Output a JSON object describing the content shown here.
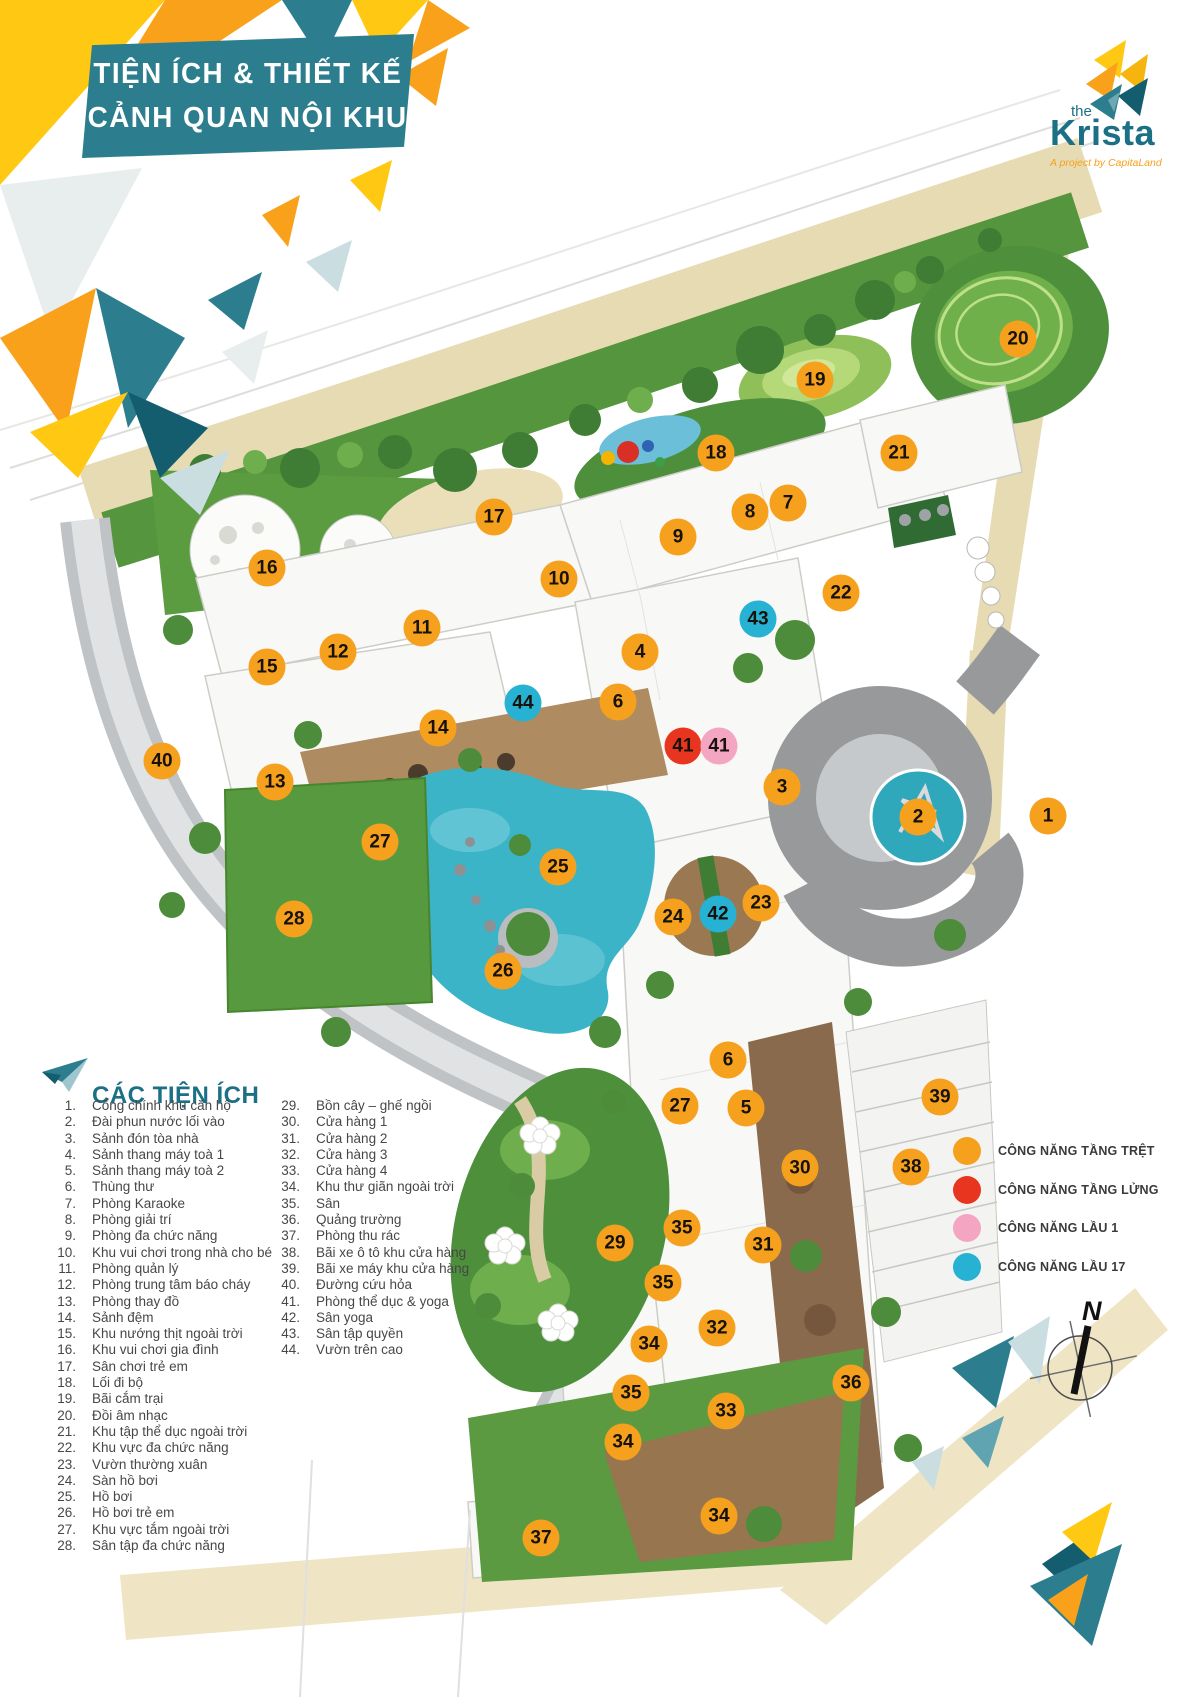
{
  "banner": {
    "line1": "TIỆN ÍCH & THIẾT KẾ",
    "line2": "CẢNH QUAN NỘI KHU"
  },
  "logo": {
    "prefix": "the",
    "name": "Krista",
    "tagline": "A project by CapitaLand"
  },
  "amenities": {
    "heading": "CÁC TIỆN ÍCH",
    "items_left": [
      {
        "num": "1.",
        "label": "Cổng chính khu căn hộ"
      },
      {
        "num": "2.",
        "label": "Đài phun nước lối vào"
      },
      {
        "num": "3.",
        "label": "Sảnh đón tòa nhà"
      },
      {
        "num": "4.",
        "label": "Sảnh thang máy toà 1"
      },
      {
        "num": "5.",
        "label": "Sảnh thang máy toà 2"
      },
      {
        "num": "6.",
        "label": "Thùng thư"
      },
      {
        "num": "7.",
        "label": "Phòng Karaoke"
      },
      {
        "num": "8.",
        "label": "Phòng giải trí"
      },
      {
        "num": "9.",
        "label": "Phòng đa chức năng"
      },
      {
        "num": "10.",
        "label": "Khu vui chơi trong nhà cho bé"
      },
      {
        "num": "11.",
        "label": "Phòng quản lý"
      },
      {
        "num": "12.",
        "label": "Phòng trung tâm báo cháy"
      },
      {
        "num": "13.",
        "label": "Phòng thay đồ"
      },
      {
        "num": "14.",
        "label": "Sảnh đệm"
      },
      {
        "num": "15.",
        "label": "Khu nướng thịt ngoài trời"
      },
      {
        "num": "16.",
        "label": "Khu vui chơi gia đình"
      },
      {
        "num": "17.",
        "label": "Sân chơi trẻ em"
      },
      {
        "num": "18.",
        "label": "Lối đi bộ"
      },
      {
        "num": "19.",
        "label": "Bãi cắm trại"
      },
      {
        "num": "20.",
        "label": "Đồi âm nhạc"
      },
      {
        "num": "21.",
        "label": "Khu tập thể dục ngoài trời"
      },
      {
        "num": "22.",
        "label": "Khu vực đa chức năng"
      },
      {
        "num": "23.",
        "label": "Vườn thường xuân"
      },
      {
        "num": "24.",
        "label": "Sàn hồ bơi"
      },
      {
        "num": "25.",
        "label": "Hồ bơi"
      },
      {
        "num": "26.",
        "label": "Hồ bơi trẻ em"
      },
      {
        "num": "27.",
        "label": "Khu vực tắm ngoài trời"
      },
      {
        "num": "28.",
        "label": "Sân tập đa chức năng"
      }
    ],
    "items_right": [
      {
        "num": "29.",
        "label": "Bồn cây – ghế ngồi"
      },
      {
        "num": "30.",
        "label": "Cửa hàng 1"
      },
      {
        "num": "31.",
        "label": "Cửa hàng 2"
      },
      {
        "num": "32.",
        "label": "Cửa hàng 3"
      },
      {
        "num": "33.",
        "label": "Cửa hàng 4"
      },
      {
        "num": "34.",
        "label": "Khu thư giãn ngoài trời"
      },
      {
        "num": "35.",
        "label": "Sân"
      },
      {
        "num": "36.",
        "label": "Quảng trường"
      },
      {
        "num": "37.",
        "label": "Phòng thu rác"
      },
      {
        "num": "38.",
        "label": "Bãi xe ô tô khu cửa hàng"
      },
      {
        "num": "39.",
        "label": "Bãi xe máy khu cửa hàng"
      },
      {
        "num": "40.",
        "label": "Đường cứu hỏa"
      },
      {
        "num": "41.",
        "label": "Phòng thể dục & yoga"
      },
      {
        "num": "42.",
        "label": "Sân yoga"
      },
      {
        "num": "43.",
        "label": "Sân tập quyền"
      },
      {
        "num": "44.",
        "label": "Vườn trên cao"
      }
    ]
  },
  "floor_legend": {
    "items": [
      {
        "label": "CÔNG NĂNG TẦNG TRỆT",
        "color": "#F6A11E"
      },
      {
        "label": "CÔNG NĂNG TẦNG LỬNG",
        "color": "#E8351F"
      },
      {
        "label": "CÔNG NĂNG LẦU 1",
        "color": "#F3A5C2"
      },
      {
        "label": "CÔNG NĂNG LẦU 17",
        "color": "#27B1D2"
      }
    ]
  },
  "compass": {
    "label": "N"
  },
  "map": {
    "marker_colors": {
      "ground": "#F6A11E",
      "mezzanine": "#E8351F",
      "floor1": "#F3A5C2",
      "floor17": "#27B1D2"
    },
    "markers": [
      {
        "n": "20",
        "x": 1018,
        "y": 339,
        "floor": "ground"
      },
      {
        "n": "19",
        "x": 815,
        "y": 380,
        "floor": "ground"
      },
      {
        "n": "18",
        "x": 716,
        "y": 453,
        "floor": "ground"
      },
      {
        "n": "21",
        "x": 899,
        "y": 453,
        "floor": "ground"
      },
      {
        "n": "7",
        "x": 788,
        "y": 503,
        "floor": "ground"
      },
      {
        "n": "8",
        "x": 750,
        "y": 512,
        "floor": "ground"
      },
      {
        "n": "17",
        "x": 494,
        "y": 517,
        "floor": "ground"
      },
      {
        "n": "9",
        "x": 678,
        "y": 537,
        "floor": "ground"
      },
      {
        "n": "16",
        "x": 267,
        "y": 568,
        "floor": "ground"
      },
      {
        "n": "10",
        "x": 559,
        "y": 579,
        "floor": "ground"
      },
      {
        "n": "22",
        "x": 841,
        "y": 593,
        "floor": "ground"
      },
      {
        "n": "43",
        "x": 758,
        "y": 619,
        "floor": "floor17"
      },
      {
        "n": "11",
        "x": 422,
        "y": 628,
        "floor": "ground"
      },
      {
        "n": "4",
        "x": 640,
        "y": 652,
        "floor": "ground"
      },
      {
        "n": "12",
        "x": 338,
        "y": 652,
        "floor": "ground"
      },
      {
        "n": "15",
        "x": 267,
        "y": 667,
        "floor": "ground"
      },
      {
        "n": "6",
        "x": 618,
        "y": 702,
        "floor": "ground"
      },
      {
        "n": "44",
        "x": 523,
        "y": 703,
        "floor": "floor17"
      },
      {
        "n": "14",
        "x": 438,
        "y": 728,
        "floor": "ground"
      },
      {
        "n": "41",
        "x": 683,
        "y": 746,
        "floor": "mezzanine"
      },
      {
        "n": "41",
        "x": 719,
        "y": 746,
        "floor": "floor1"
      },
      {
        "n": "40",
        "x": 162,
        "y": 761,
        "floor": "ground"
      },
      {
        "n": "13",
        "x": 275,
        "y": 782,
        "floor": "ground"
      },
      {
        "n": "3",
        "x": 782,
        "y": 787,
        "floor": "ground"
      },
      {
        "n": "1",
        "x": 1048,
        "y": 816,
        "floor": "ground"
      },
      {
        "n": "2",
        "x": 918,
        "y": 817,
        "floor": "ground"
      },
      {
        "n": "27",
        "x": 380,
        "y": 842,
        "floor": "ground"
      },
      {
        "n": "25",
        "x": 558,
        "y": 867,
        "floor": "ground"
      },
      {
        "n": "23",
        "x": 761,
        "y": 903,
        "floor": "ground"
      },
      {
        "n": "42",
        "x": 718,
        "y": 914,
        "floor": "floor17"
      },
      {
        "n": "24",
        "x": 673,
        "y": 917,
        "floor": "ground"
      },
      {
        "n": "28",
        "x": 294,
        "y": 919,
        "floor": "ground"
      },
      {
        "n": "26",
        "x": 503,
        "y": 971,
        "floor": "ground"
      },
      {
        "n": "6",
        "x": 728,
        "y": 1060,
        "floor": "ground"
      },
      {
        "n": "39",
        "x": 940,
        "y": 1097,
        "floor": "ground"
      },
      {
        "n": "27",
        "x": 680,
        "y": 1106,
        "floor": "ground"
      },
      {
        "n": "5",
        "x": 746,
        "y": 1108,
        "floor": "ground"
      },
      {
        "n": "38",
        "x": 911,
        "y": 1167,
        "floor": "ground"
      },
      {
        "n": "30",
        "x": 800,
        "y": 1168,
        "floor": "ground"
      },
      {
        "n": "35",
        "x": 682,
        "y": 1228,
        "floor": "ground"
      },
      {
        "n": "29",
        "x": 615,
        "y": 1243,
        "floor": "ground"
      },
      {
        "n": "31",
        "x": 763,
        "y": 1245,
        "floor": "ground"
      },
      {
        "n": "35",
        "x": 663,
        "y": 1283,
        "floor": "ground"
      },
      {
        "n": "32",
        "x": 717,
        "y": 1328,
        "floor": "ground"
      },
      {
        "n": "34",
        "x": 649,
        "y": 1344,
        "floor": "ground"
      },
      {
        "n": "36",
        "x": 851,
        "y": 1383,
        "floor": "ground"
      },
      {
        "n": "35",
        "x": 631,
        "y": 1393,
        "floor": "ground"
      },
      {
        "n": "33",
        "x": 726,
        "y": 1411,
        "floor": "ground"
      },
      {
        "n": "34",
        "x": 623,
        "y": 1442,
        "floor": "ground"
      },
      {
        "n": "34",
        "x": 719,
        "y": 1516,
        "floor": "ground"
      },
      {
        "n": "37",
        "x": 541,
        "y": 1538,
        "floor": "ground"
      }
    ]
  }
}
